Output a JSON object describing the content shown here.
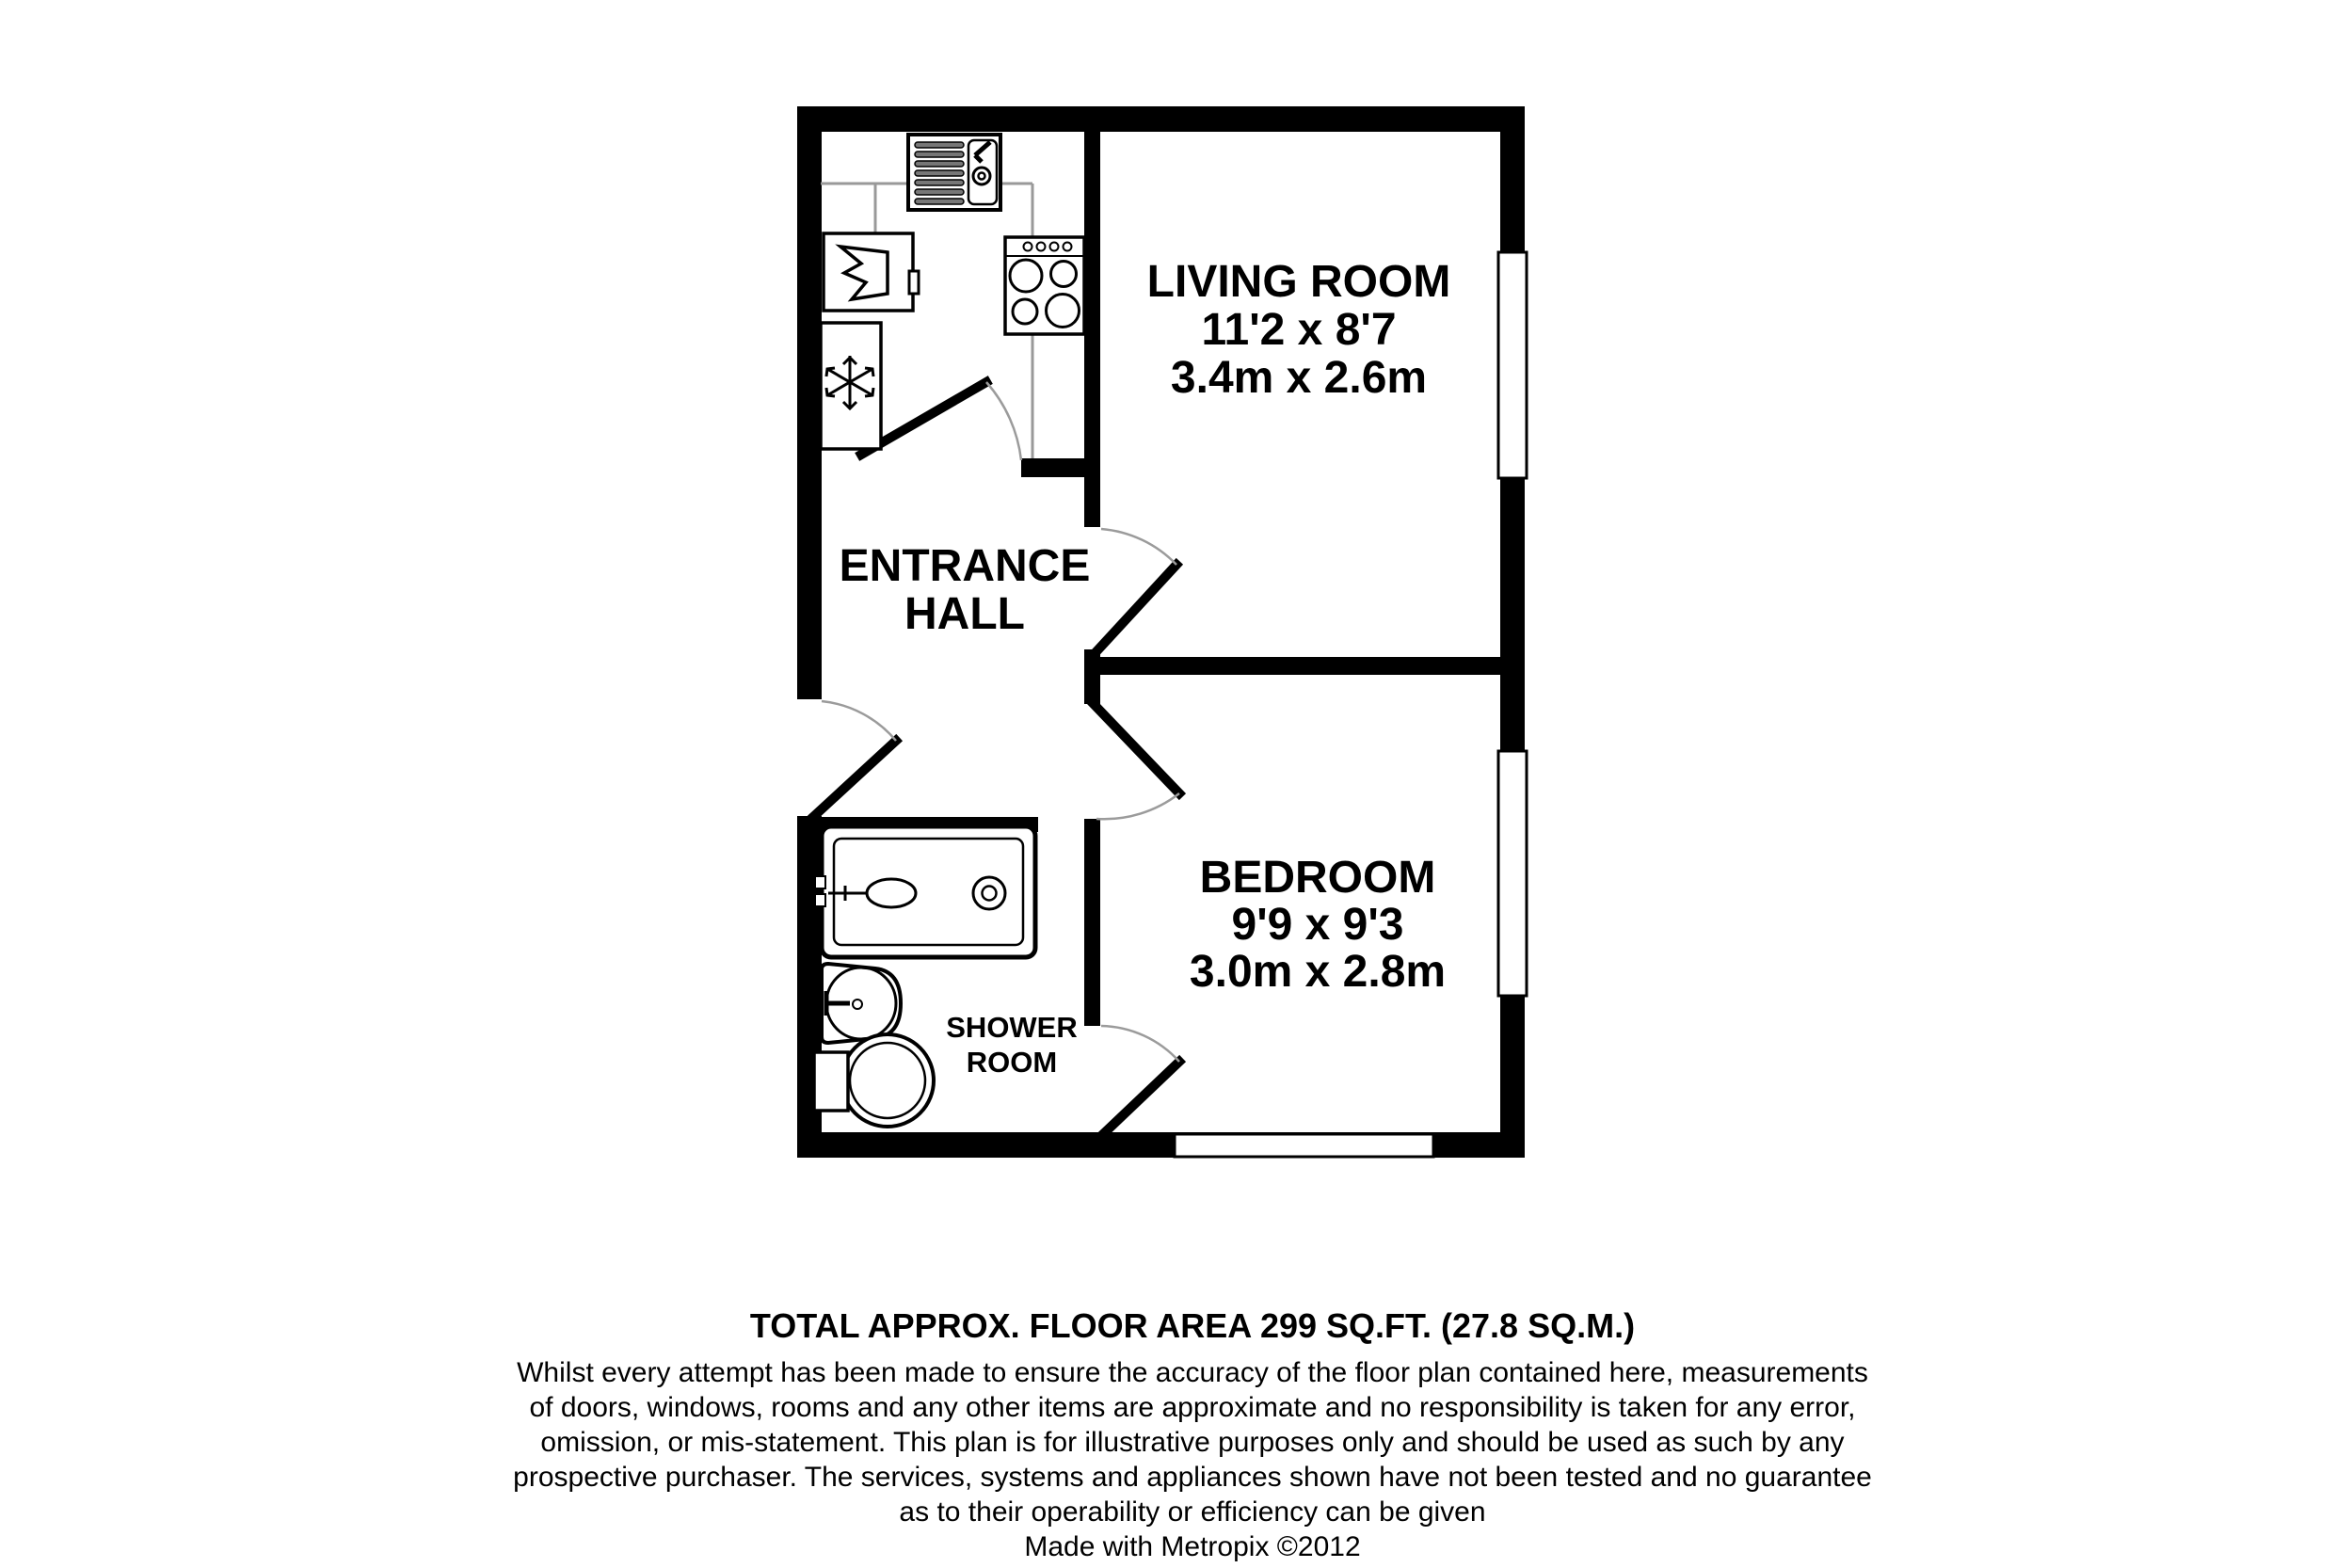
{
  "plan": {
    "rooms": {
      "living_room": {
        "label": "LIVING ROOM",
        "imperial": "11'2 x 8'7",
        "metric": "3.4m x 2.6m"
      },
      "entrance_hall": {
        "line1": "ENTRANCE",
        "line2": "HALL"
      },
      "bedroom": {
        "label": "BEDROOM",
        "imperial": "9'9 x 9'3",
        "metric": "3.0m x 2.8m"
      },
      "shower_room": {
        "line1": "SHOWER",
        "line2": "ROOM"
      }
    },
    "fixture_icons": {
      "kitchen": [
        "sink-drainer-icon",
        "appliance-icon",
        "freezer-snowflake-icon",
        "hob-icon"
      ],
      "shower_room": [
        "shower-enclosure-icon",
        "wash-basin-icon",
        "toilet-icon"
      ]
    },
    "window_count": 3,
    "colors": {
      "wall": "#000000",
      "background": "#ffffff",
      "door_arc": "#9b9b9b",
      "counter_line": "#999999"
    }
  },
  "footer": {
    "area_line": "TOTAL APPROX. FLOOR AREA 299 SQ.FT. (27.8 SQ.M.)",
    "disclaimer_lines": [
      "Whilst every attempt has been made to ensure the accuracy of the floor plan contained here, measurements",
      "of doors, windows, rooms and any other items are approximate and no responsibility is taken for any error,",
      "omission, or mis-statement. This plan is for illustrative purposes only and should be used as such by any",
      "prospective purchaser. The services, systems and appliances shown have not been tested and no guarantee",
      "as to their operability or efficiency can be given"
    ],
    "credit": "Made with Metropix ©2012"
  }
}
